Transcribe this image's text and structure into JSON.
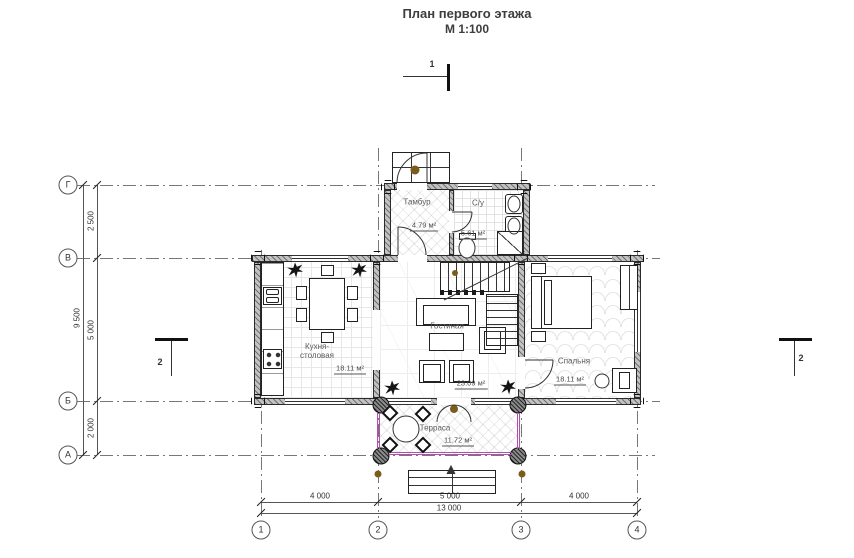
{
  "title": {
    "line1": "План первого этажа",
    "line2": "М 1:100"
  },
  "axes": {
    "rows": [
      "Г",
      "В",
      "Б",
      "А"
    ],
    "cols": [
      "1",
      "2",
      "3",
      "4"
    ]
  },
  "dims": {
    "left_total": "9 500",
    "left_segments": [
      "2 500",
      "5 000",
      "2 000"
    ],
    "bottom_segments": [
      "4 000",
      "5 000",
      "4 000"
    ],
    "bottom_total": "13 000"
  },
  "sections": {
    "top": "1",
    "left": "2",
    "right": "2"
  },
  "rooms": [
    {
      "name": "Тамбур",
      "area": "4.79 м²"
    },
    {
      "name": "С/у",
      "area": "5.61 м²"
    },
    {
      "name": "Кухня-столовая",
      "area": "18.11 м²"
    },
    {
      "name": "Гостиная",
      "area": "23.09 м²"
    },
    {
      "name": "Спальня",
      "area": "18.11 м²"
    },
    {
      "name": "Терраса",
      "area": "11.72 м²"
    }
  ],
  "colors": {
    "wall_fill": "#c2c2c2",
    "line": "#333333",
    "railing": "#b14fb1",
    "plant_brown": "#7a5c1f"
  }
}
